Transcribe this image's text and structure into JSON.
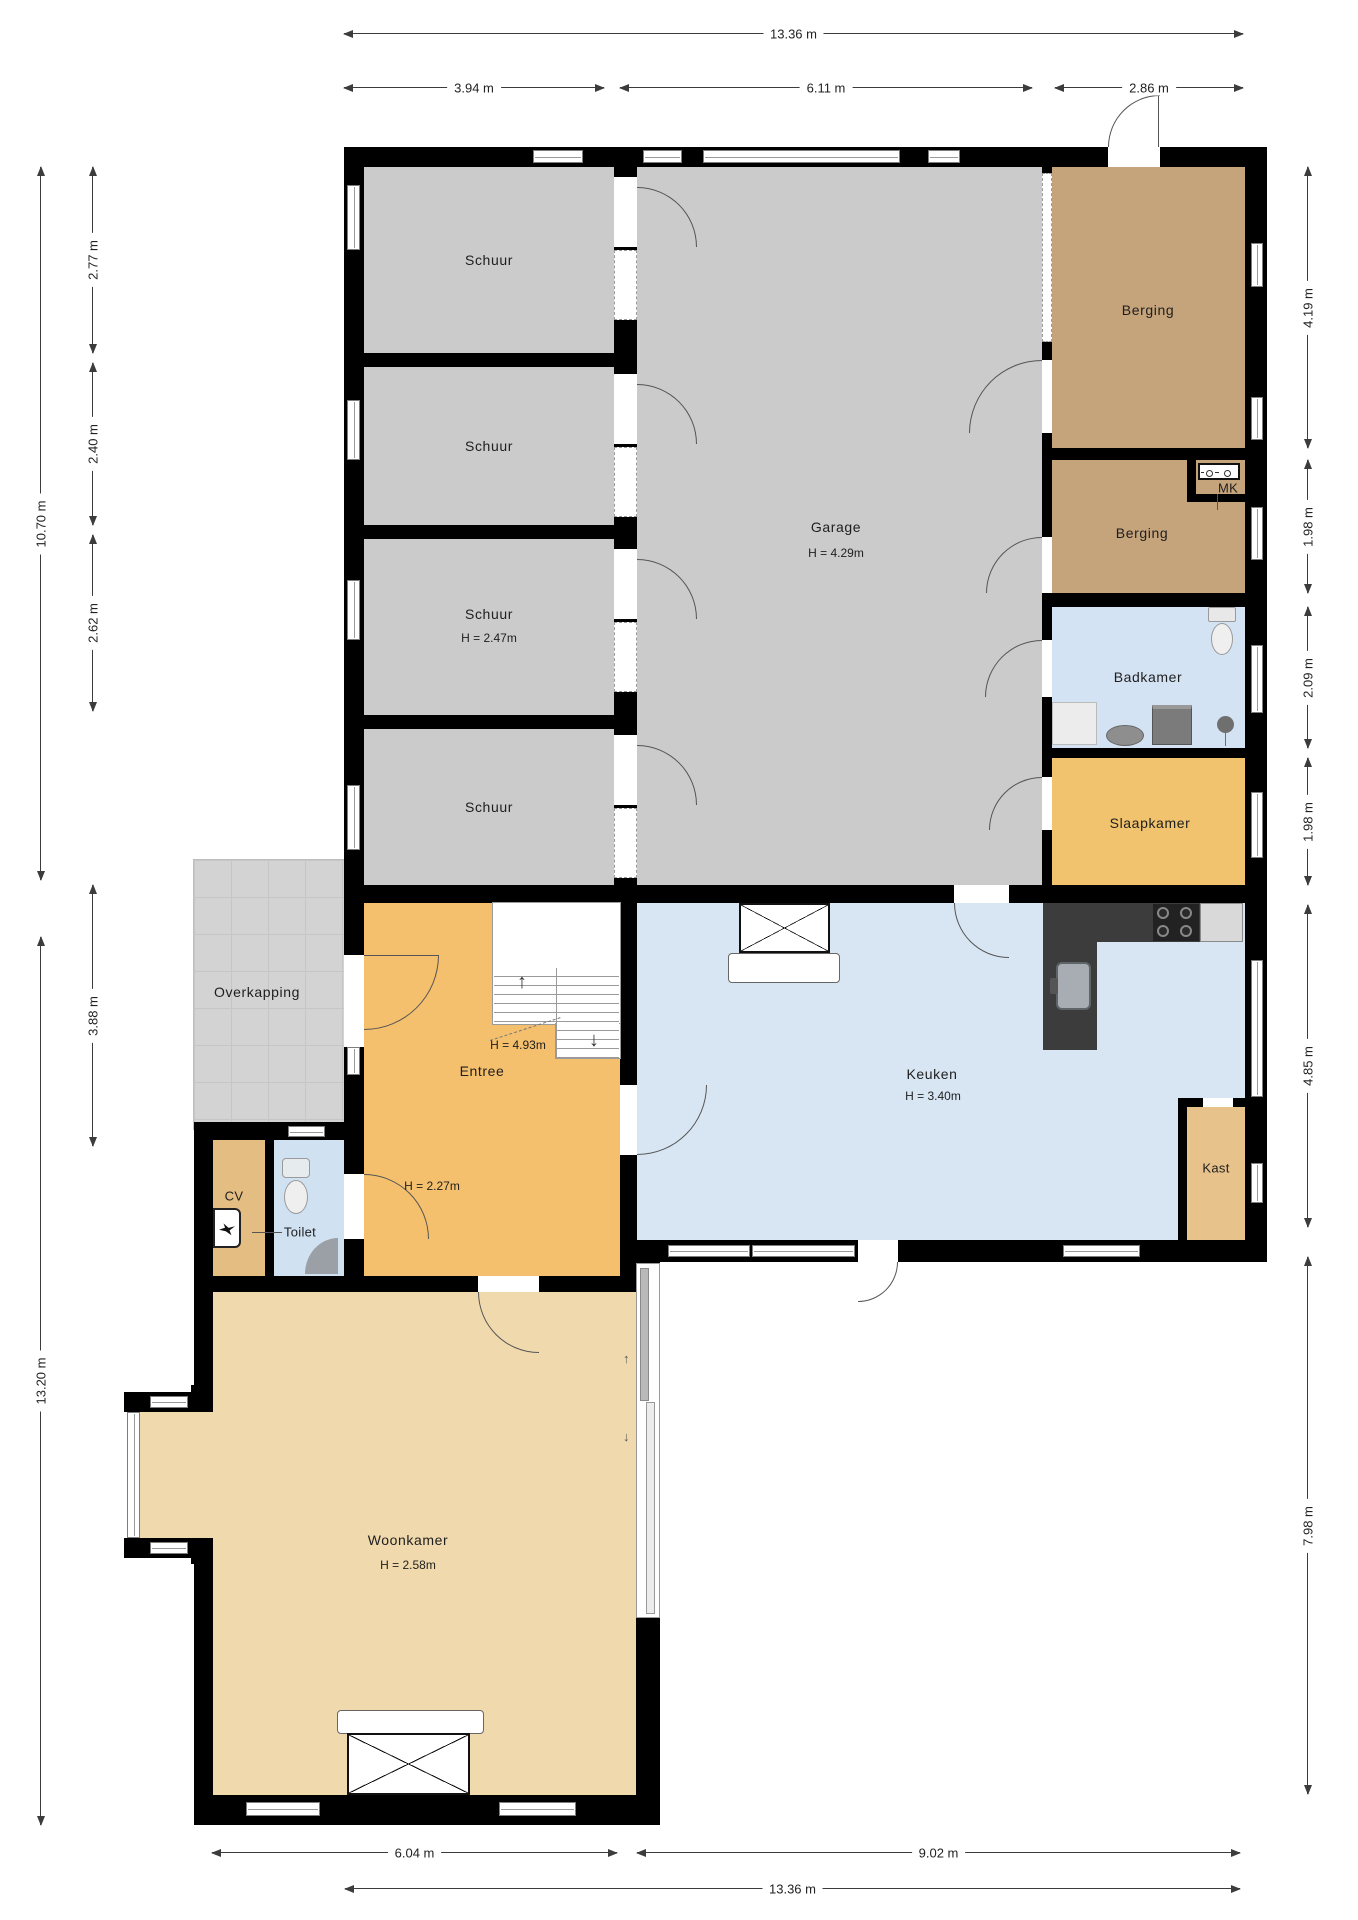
{
  "plan_title": "Begane grond floor plan (Dutch residential)",
  "rooms": {
    "schuur_1": {
      "label": "Schuur"
    },
    "schuur_2": {
      "label": "Schuur"
    },
    "schuur_3": {
      "label": "Schuur",
      "ceiling": "H = 2.47m"
    },
    "schuur_4": {
      "label": "Schuur"
    },
    "garage": {
      "label": "Garage",
      "ceiling": "H = 4.29m"
    },
    "berging_1": {
      "label": "Berging"
    },
    "mk": {
      "label": "MK"
    },
    "berging_2": {
      "label": "Berging"
    },
    "badkamer": {
      "label": "Badkamer"
    },
    "slaapkamer": {
      "label": "Slaapkamer"
    },
    "overkapping": {
      "label": "Overkapping"
    },
    "entree": {
      "label": "Entree",
      "ceiling_stairwell": "H = 4.93m",
      "ceiling": "H = 2.27m"
    },
    "keuken": {
      "label": "Keuken",
      "ceiling": "H = 3.40m"
    },
    "kast": {
      "label": "Kast"
    },
    "cv": {
      "label": "CV"
    },
    "toilet": {
      "label": "Toilet"
    },
    "woonkamer": {
      "label": "Woonkamer",
      "ceiling": "H = 2.58m"
    }
  },
  "dimensions": {
    "top_total": "13.36 m",
    "top_segments": [
      "3.94 m",
      "6.11 m",
      "2.86 m"
    ],
    "left_outer": [
      "10.70 m",
      "13.20 m"
    ],
    "left_inner": [
      "2.77 m",
      "2.40 m",
      "2.62 m",
      "3.88 m"
    ],
    "right": [
      "4.19 m",
      "1.98 m",
      "2.09 m",
      "1.98 m",
      "4.85 m",
      "7.98 m"
    ],
    "bottom_segments": [
      "6.04 m",
      "9.02 m"
    ],
    "bottom_total": "13.36 m"
  },
  "colors": {
    "wall": "#000000",
    "shed_garage_floor": "#cbcbcb",
    "storage_floor": "#c5a37b",
    "bathroom_floor": "#d4e3f3",
    "bedroom_floor": "#f1c36e",
    "kitchen_floor": "#d8e6f4",
    "hall_floor": "#f5c06d",
    "closet_floor": "#e8c28b",
    "cv_floor": "#e4bd83",
    "toilet_floor": "#d0e1f2",
    "living_floor": "#f0daad",
    "canopy_floor": "#d3d3d3",
    "kitchen_counter": "#3c3c3c",
    "dimension_text": "#222222"
  }
}
